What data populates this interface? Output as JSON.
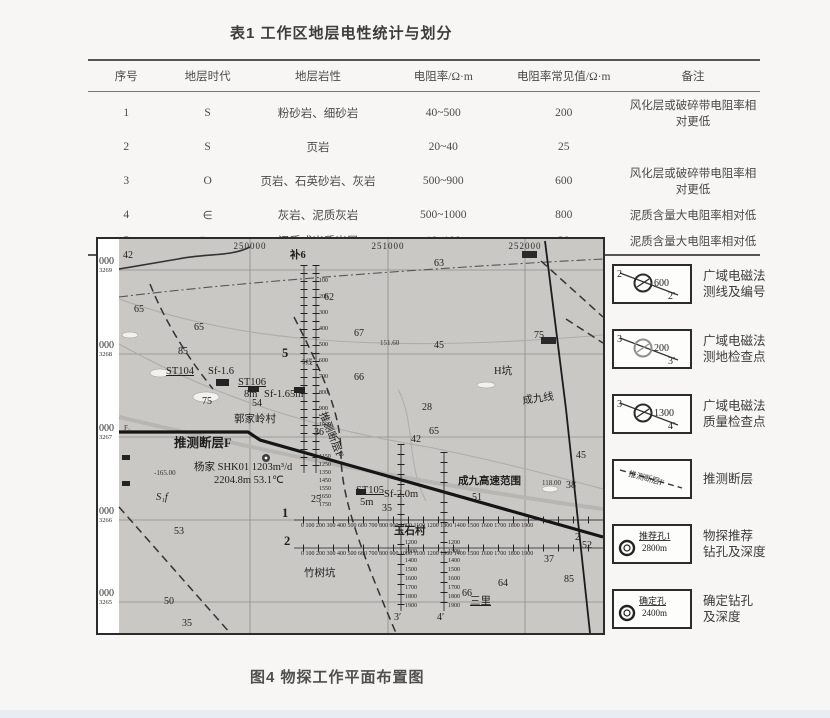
{
  "table": {
    "title": "表1 工作区地层电性统计与划分",
    "headers": [
      "序号",
      "地层时代",
      "地层岩性",
      "电阻率/Ω·m",
      "电阻率常见值/Ω·m",
      "备注"
    ],
    "rows": [
      [
        "1",
        "S",
        "粉砂岩、细砂岩",
        "40~500",
        "200",
        "风化层或破碎带电阻率相对更低"
      ],
      [
        "2",
        "S",
        "页岩",
        "20~40",
        "25",
        ""
      ],
      [
        "3",
        "O",
        "页岩、石英砂岩、灰岩",
        "500~900",
        "600",
        "风化层或破碎带电阻率相对更低"
      ],
      [
        "4",
        "∈",
        "灰岩、泥质灰岩",
        "500~1000",
        "800",
        "泥质含量大电阻率相对低"
      ],
      [
        "5",
        "∈+Z",
        "泥质或炭质岩层",
        "10~100",
        "20",
        "泥质含量大电阻率相对低"
      ]
    ]
  },
  "figure": {
    "caption": "图4 物探工作平面布置图",
    "map": {
      "x_axis_labels": [
        {
          "text": "250000",
          "x": 152
        },
        {
          "text": "251000",
          "x": 290
        },
        {
          "text": "252000",
          "x": 427
        }
      ],
      "y_axis_labels": [
        {
          "big": "000",
          "small": "3269",
          "y": 18
        },
        {
          "big": "000",
          "small": "3268",
          "y": 102
        },
        {
          "big": "000",
          "small": "3267",
          "y": 185
        },
        {
          "big": "000",
          "small": "3266",
          "y": 268
        },
        {
          "big": "000",
          "small": "3265",
          "y": 350
        }
      ],
      "labels": [
        {
          "t": "42",
          "x": 25,
          "y": 12,
          "c": "num"
        },
        {
          "t": "65",
          "x": 36,
          "y": 66,
          "c": "num"
        },
        {
          "t": "65",
          "x": 96,
          "y": 84,
          "c": "num"
        },
        {
          "t": "85",
          "x": 80,
          "y": 108,
          "c": "num"
        },
        {
          "t": "62",
          "x": 226,
          "y": 54,
          "c": "num"
        },
        {
          "t": "63",
          "x": 336,
          "y": 20,
          "c": "num"
        },
        {
          "t": "67",
          "x": 256,
          "y": 90,
          "c": "num"
        },
        {
          "t": "151.60",
          "x": 282,
          "y": 101,
          "c": "tiny"
        },
        {
          "t": "45",
          "x": 336,
          "y": 102,
          "c": "num"
        },
        {
          "t": "75",
          "x": 436,
          "y": 92,
          "c": "num"
        },
        {
          "t": "66",
          "x": 256,
          "y": 134,
          "c": "num"
        },
        {
          "t": "28",
          "x": 324,
          "y": 164,
          "c": "num"
        },
        {
          "t": "65",
          "x": 331,
          "y": 188,
          "c": "num"
        },
        {
          "t": "36",
          "x": 216,
          "y": 189,
          "c": "num"
        },
        {
          "t": "42",
          "x": 313,
          "y": 196,
          "c": "num"
        },
        {
          "t": "45",
          "x": 478,
          "y": 212,
          "c": "num"
        },
        {
          "t": "H坑",
          "x": 396,
          "y": 128,
          "c": "name"
        },
        {
          "t": "成九线",
          "x": 424,
          "y": 158,
          "c": "name rot"
        },
        {
          "t": "补6",
          "x": 192,
          "y": 12,
          "c": "name bold"
        },
        {
          "t": "ST104",
          "x": 68,
          "y": 128,
          "c": "name ul"
        },
        {
          "t": "Sf-1.6",
          "x": 110,
          "y": 128,
          "c": "name"
        },
        {
          "t": "ST106",
          "x": 140,
          "y": 139,
          "c": "name ul"
        },
        {
          "t": "8m",
          "x": 146,
          "y": 151,
          "c": "name"
        },
        {
          "t": "Sf-1.65m",
          "x": 166,
          "y": 151,
          "c": "name"
        },
        {
          "t": "75",
          "x": 104,
          "y": 158,
          "c": "num"
        },
        {
          "t": "54",
          "x": 154,
          "y": 160,
          "c": "num"
        },
        {
          "t": "5线",
          "x": 204,
          "y": 120,
          "c": "tiny"
        },
        {
          "t": "5",
          "x": 184,
          "y": 108,
          "c": "big"
        },
        {
          "t": "郭家岭村",
          "x": 136,
          "y": 176,
          "c": "name"
        },
        {
          "t": "推测断层F",
          "x": 76,
          "y": 198,
          "c": "big"
        },
        {
          "t": "推测断层F",
          "x": 228,
          "y": 172,
          "c": "name rotf"
        },
        {
          "t": "F₁",
          "x": 26,
          "y": 186,
          "c": "tiny"
        },
        {
          "t": "杨家 SHK01 1203m³/d",
          "x": 96,
          "y": 224,
          "c": "name"
        },
        {
          "t": "2204.8m 53.1℃",
          "x": 116,
          "y": 237,
          "c": "name"
        },
        {
          "t": "-165.00",
          "x": 56,
          "y": 231,
          "c": "tiny"
        },
        {
          "t": "S₁f",
          "x": 58,
          "y": 254,
          "c": "name it"
        },
        {
          "t": "ST105",
          "x": 258,
          "y": 247,
          "c": "name ul"
        },
        {
          "t": "5m",
          "x": 262,
          "y": 259,
          "c": "name"
        },
        {
          "t": "Sf-2.0m",
          "x": 286,
          "y": 251,
          "c": "name"
        },
        {
          "t": "35",
          "x": 284,
          "y": 265,
          "c": "num"
        },
        {
          "t": "成九高速范围",
          "x": 360,
          "y": 238,
          "c": "name bold"
        },
        {
          "t": "51",
          "x": 374,
          "y": 254,
          "c": "num"
        },
        {
          "t": "118.00",
          "x": 444,
          "y": 241,
          "c": "tiny"
        },
        {
          "t": "38",
          "x": 468,
          "y": 242,
          "c": "num"
        },
        {
          "t": "25",
          "x": 213,
          "y": 256,
          "c": "num"
        },
        {
          "t": "1",
          "x": 184,
          "y": 268,
          "c": "big"
        },
        {
          "t": "2",
          "x": 186,
          "y": 296,
          "c": "big"
        },
        {
          "t": "2",
          "x": 477,
          "y": 294,
          "c": "num"
        },
        {
          "t": "52",
          "x": 484,
          "y": 302,
          "c": "num"
        },
        {
          "t": "53",
          "x": 76,
          "y": 288,
          "c": "num"
        },
        {
          "t": "50",
          "x": 66,
          "y": 358,
          "c": "num"
        },
        {
          "t": "35",
          "x": 84,
          "y": 380,
          "c": "num"
        },
        {
          "t": "竹树坑",
          "x": 206,
          "y": 330,
          "c": "name"
        },
        {
          "t": "玉石村",
          "x": 296,
          "y": 288,
          "c": "name bold"
        },
        {
          "t": "三里",
          "x": 372,
          "y": 358,
          "c": "name ul"
        },
        {
          "t": "66",
          "x": 364,
          "y": 350,
          "c": "num"
        },
        {
          "t": "64",
          "x": 400,
          "y": 340,
          "c": "num"
        },
        {
          "t": "37",
          "x": 446,
          "y": 316,
          "c": "num"
        },
        {
          "t": "85",
          "x": 466,
          "y": 336,
          "c": "num"
        },
        {
          "t": "3′",
          "x": 296,
          "y": 374,
          "c": "num"
        },
        {
          "t": "4′",
          "x": 339,
          "y": 374,
          "c": "num"
        }
      ],
      "station_rows": [
        {
          "text": "0 100 200 300 400 500 600 700 800 900 1000 1100 1200 1300 1400 1500 1600 1700 1800 1900",
          "x": 203,
          "y": 284
        },
        {
          "text": "0 100 200 300 400 500 600 700 800 900 1000 1100 1200 1300 1400 1500 1600 1700 1800 1900",
          "x": 203,
          "y": 312
        }
      ],
      "station_cols": [
        {
          "items": [
            "100",
            "200",
            "300",
            "400",
            "500",
            "600",
            "700",
            "800",
            "900",
            "1000"
          ],
          "x": 221,
          "y": 34,
          "lh": 16
        },
        {
          "items": [
            "1150",
            "1250",
            "1350",
            "1450",
            "1550",
            "1650",
            "1750"
          ],
          "x": 221,
          "y": 214,
          "lh": 8
        },
        {
          "items": [
            "1200",
            "1300",
            "1400",
            "1500",
            "1600",
            "1700",
            "1800",
            "1900"
          ],
          "x": 307,
          "y": 300,
          "lh": 9
        },
        {
          "items": [
            "1200",
            "1300",
            "1400",
            "1500",
            "1600",
            "1700",
            "1800",
            "1900"
          ],
          "x": 350,
          "y": 300,
          "lh": 9
        }
      ]
    },
    "legend": {
      "items": [
        {
          "type": "line-circle",
          "tl": "2",
          "mid": "600",
          "br": "2′",
          "circle": "dark",
          "label1": "广域电磁法",
          "label2": "测线及编号"
        },
        {
          "type": "line-circle",
          "tl": "3",
          "mid": "200",
          "br": "3′",
          "circle": "light",
          "label1": "广域电磁法",
          "label2": "测地检查点"
        },
        {
          "type": "line-circle",
          "tl": "3",
          "mid": "1300",
          "br": "4′",
          "circle": "dark",
          "label1": "广域电磁法",
          "label2": "质量检查点"
        },
        {
          "type": "fault",
          "text": "推测断层F",
          "label1": "推测断层",
          "label2": ""
        },
        {
          "type": "borehole",
          "name": "推荐孔1",
          "depth": "2800m",
          "label1": "物探推荐",
          "label2": "钻孔及深度"
        },
        {
          "type": "borehole",
          "name": "确定孔",
          "depth": "2400m",
          "label1": "确定钻孔",
          "label2": "及深度"
        }
      ]
    }
  }
}
